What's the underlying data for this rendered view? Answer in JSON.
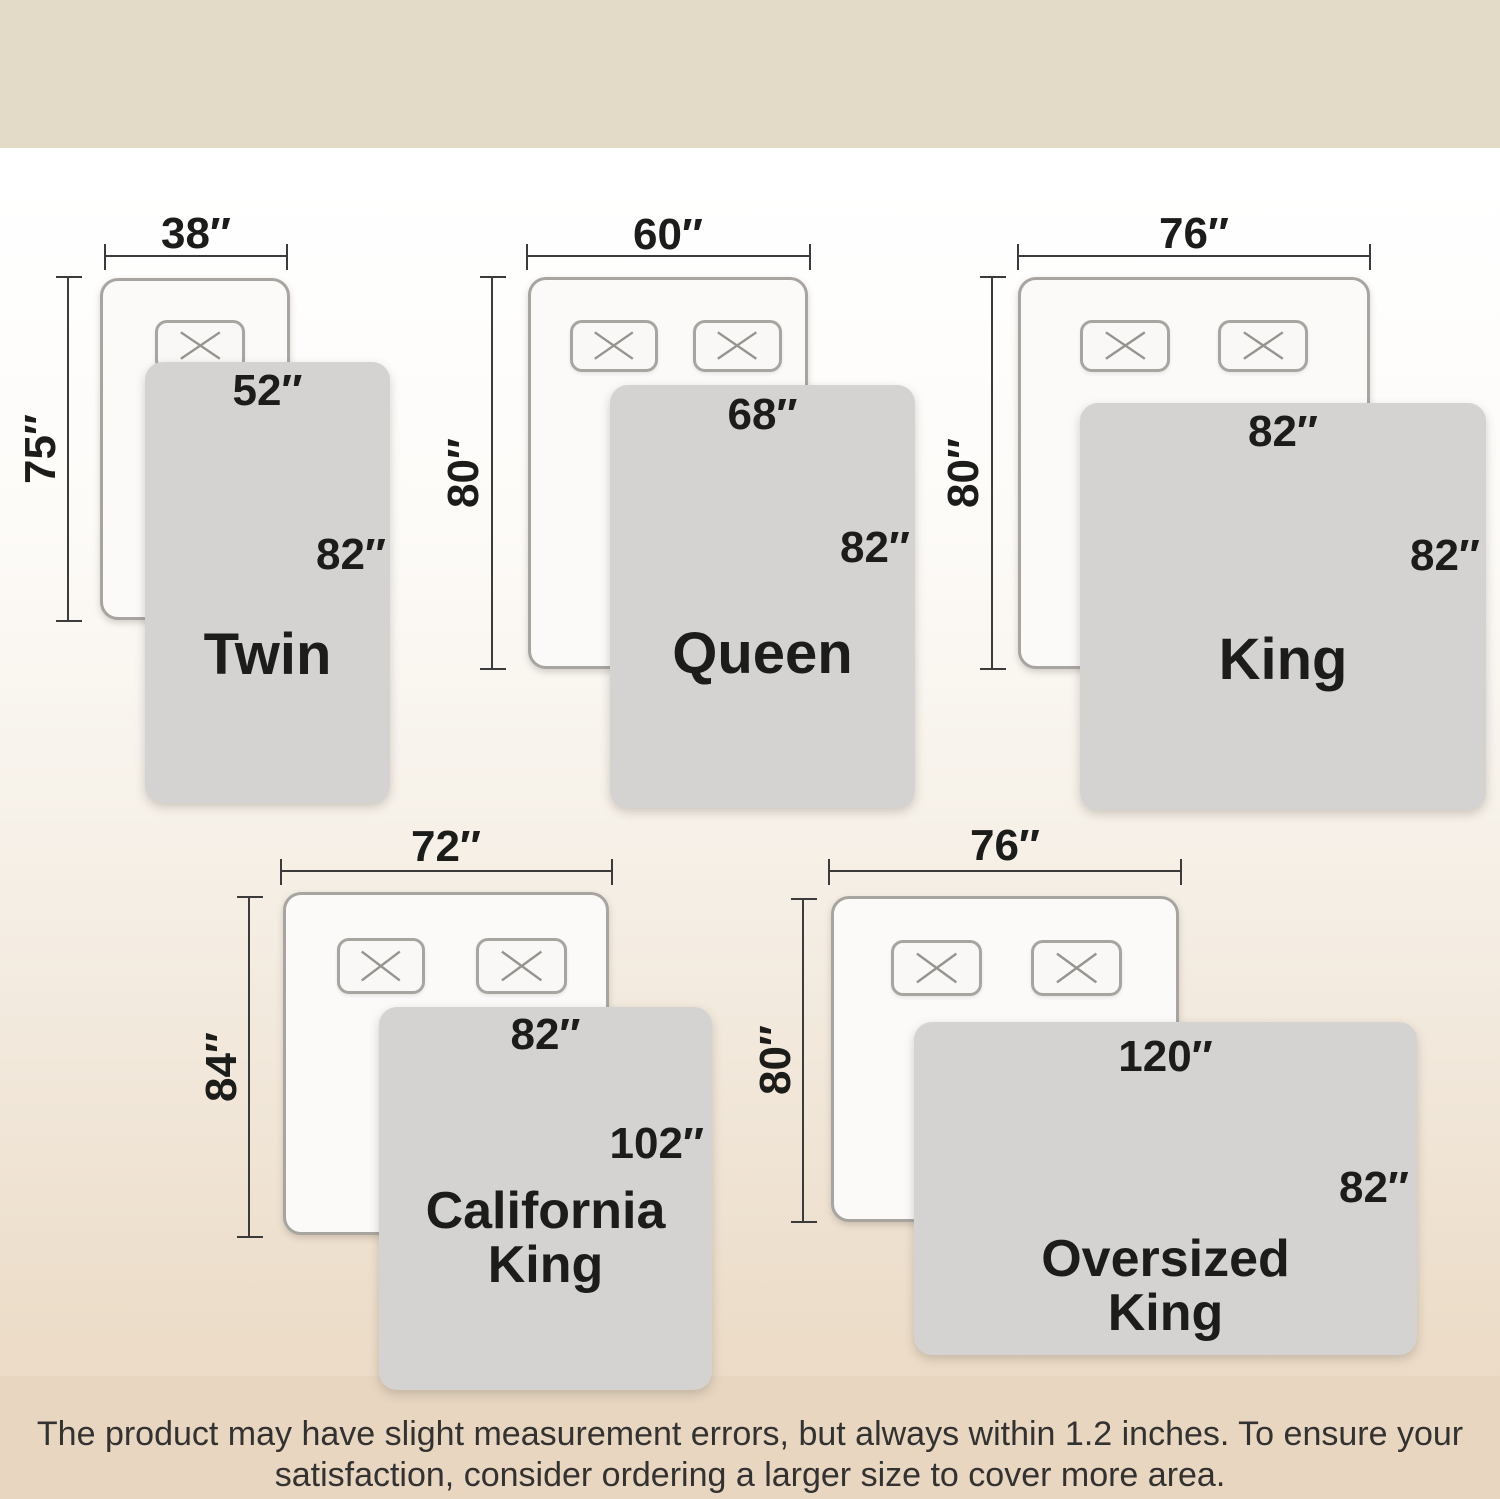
{
  "title": "SIZING INFO",
  "disclaimer": {
    "line1": "The product may have slight measurement errors, but always within 1.2 inches. To ensure your",
    "line2": "satisfaction, consider ordering a larger size to cover more area."
  },
  "sizes": [
    {
      "name": "Twin",
      "name_lines": [
        "Twin"
      ],
      "mattress_width": "38″",
      "mattress_length": "75″",
      "blanket_width": "52″",
      "blanket_length": "82″",
      "pillows": 1
    },
    {
      "name": "Queen",
      "name_lines": [
        "Queen"
      ],
      "mattress_width": "60″",
      "mattress_length": "80″",
      "blanket_width": "68″",
      "blanket_length": "82″",
      "pillows": 2
    },
    {
      "name": "King",
      "name_lines": [
        "King"
      ],
      "mattress_width": "76″",
      "mattress_length": "80″",
      "blanket_width": "82″",
      "blanket_length": "82″",
      "pillows": 2
    },
    {
      "name": "California King",
      "name_lines": [
        "California",
        "King"
      ],
      "mattress_width": "72″",
      "mattress_length": "84″",
      "blanket_width": "82″",
      "blanket_length": "102″",
      "pillows": 2
    },
    {
      "name": "Oversized King",
      "name_lines": [
        "Oversized",
        "King"
      ],
      "mattress_width": "76″",
      "mattress_length": "80″",
      "blanket_width": "120″",
      "blanket_length": "82″",
      "pillows": 2
    }
  ],
  "colors": {
    "banner_top": "#e4dac8",
    "banner_bottom": "#e8d6c1",
    "blanket_gray": "#d4d3d1",
    "mattress_white": "#fbfaf9",
    "outline_gray": "#a8a5a1",
    "measure_line": "#3b3b3b",
    "text": "#1c1c1a"
  }
}
